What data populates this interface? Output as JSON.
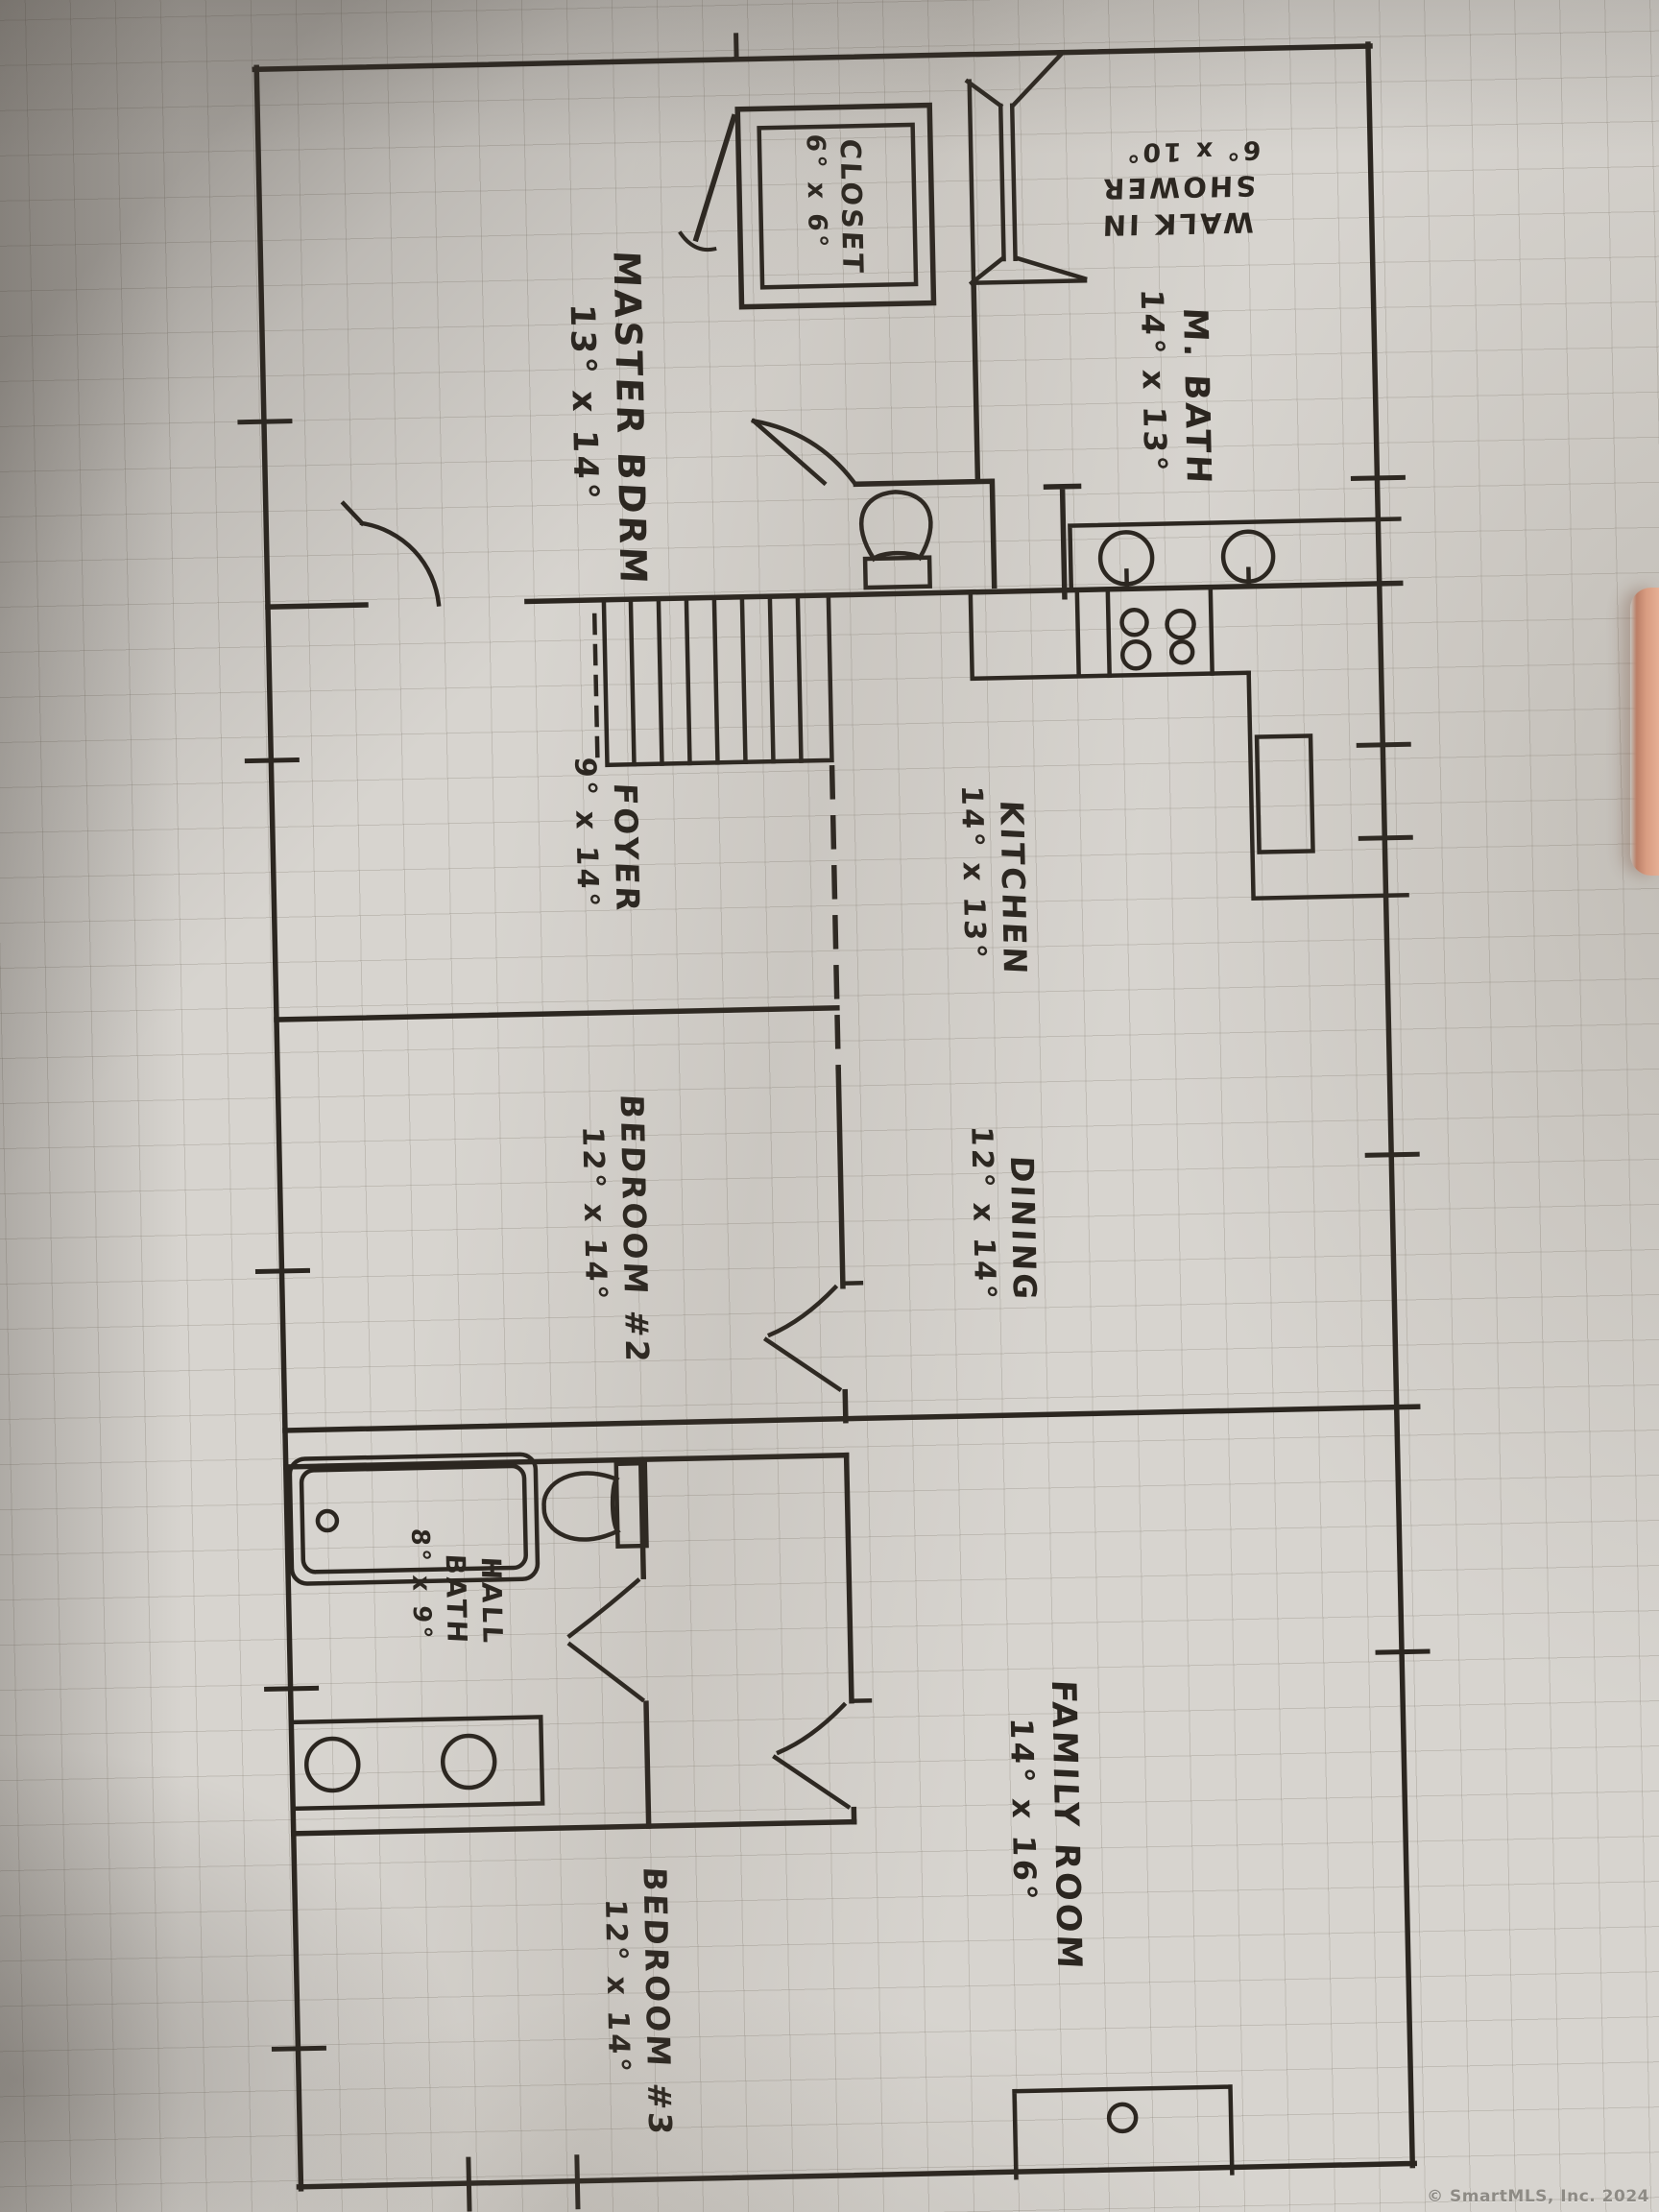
{
  "watermark": "© SmartMLS, Inc. 2024",
  "colors": {
    "ink": "#2b2620",
    "paper": "#d7d4cf",
    "watermark_gray": "#8e8b85"
  },
  "rooms": [
    {
      "id": "master-bedroom",
      "lines": [
        "MASTER BDRM",
        "13° x 14°"
      ]
    },
    {
      "id": "closet",
      "lines": [
        "CLOSET",
        "6° x 6°"
      ]
    },
    {
      "id": "walk-in-shower",
      "lines": [
        "WALK IN",
        "SHOWER",
        "6° x 10°"
      ]
    },
    {
      "id": "master-bath",
      "lines": [
        "M. BATH",
        "14° x 13°"
      ]
    },
    {
      "id": "foyer",
      "lines": [
        "FOYER",
        "9° x 14°"
      ]
    },
    {
      "id": "kitchen",
      "lines": [
        "KITCHEN",
        "14° x 13°"
      ]
    },
    {
      "id": "dining",
      "lines": [
        "DINING",
        "12° x 14°"
      ]
    },
    {
      "id": "bedroom-2",
      "lines": [
        "BEDROOM #2",
        "12° x 14°"
      ]
    },
    {
      "id": "hall-bath",
      "lines": [
        "HALL",
        "BATH",
        "8° x 9°"
      ]
    },
    {
      "id": "family-room",
      "lines": [
        "FAMILY ROOM",
        "14° x 16°"
      ]
    },
    {
      "id": "bedroom-3",
      "lines": [
        "BEDROOM #3",
        "12° x 14°"
      ]
    }
  ],
  "fixtures": [
    "stairs",
    "toilet",
    "double-vanity-sinks",
    "stove-burners",
    "refrigerator",
    "walk-in-shower-stall",
    "closet-shelf",
    "bathtub",
    "hall-toilet",
    "hall-vanity-sinks",
    "fireplace"
  ]
}
